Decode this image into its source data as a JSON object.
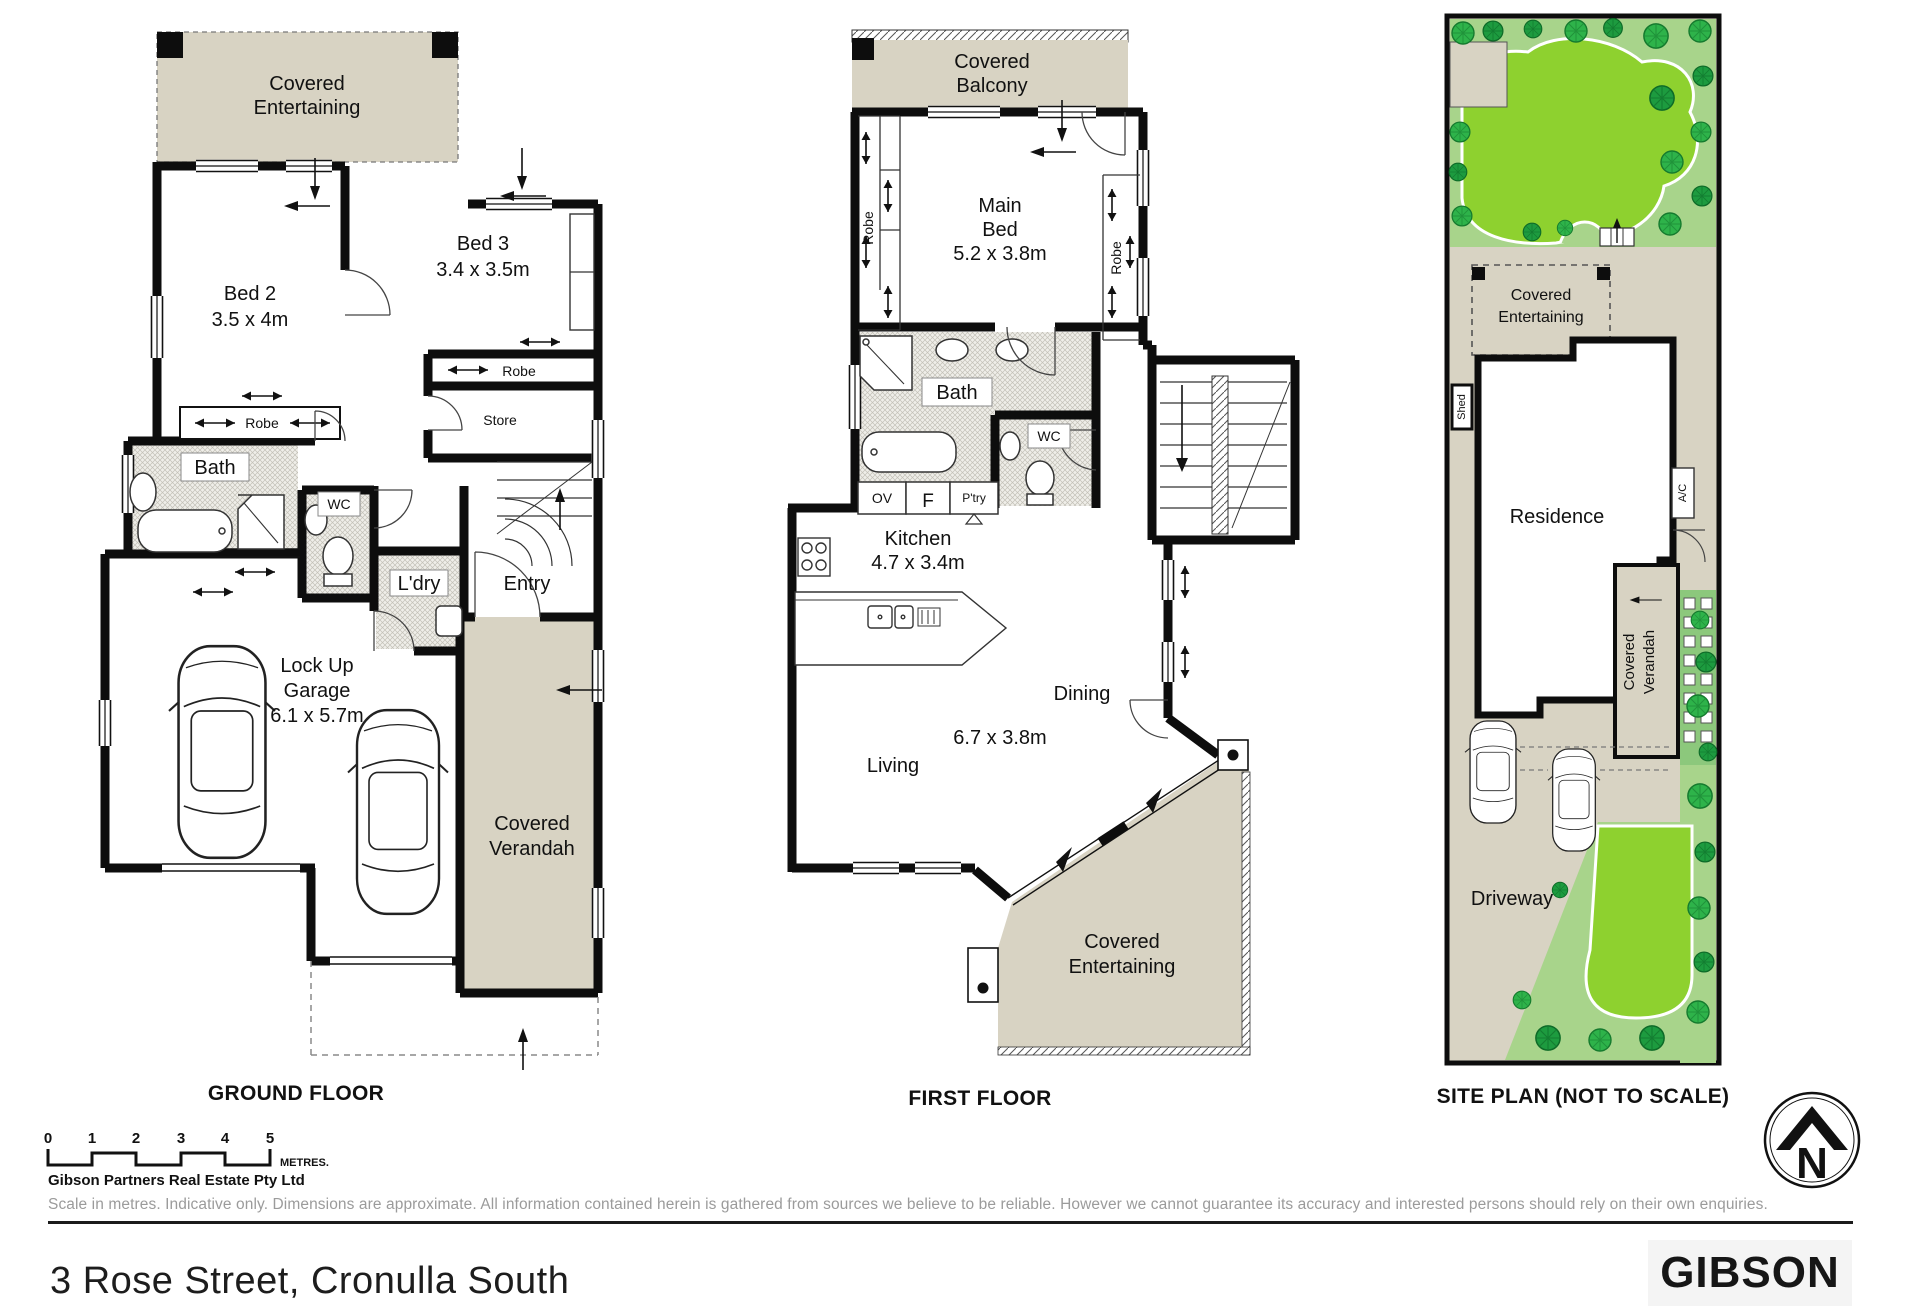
{
  "captions": {
    "ground": "GROUND FLOOR",
    "first": "FIRST FLOOR",
    "site": "SITE PLAN (NOT TO SCALE)"
  },
  "ground_floor": {
    "covered_entertaining": {
      "l1": "Covered",
      "l2": "Entertaining"
    },
    "bed2": {
      "name": "Bed 2",
      "dims": "3.5 x 4m"
    },
    "bed3": {
      "name": "Bed 3",
      "dims": "3.4 x 3.5m"
    },
    "robe_bed3": "Robe",
    "store": "Store",
    "robe_bed2": "Robe",
    "bath": "Bath",
    "wc": "WC",
    "ldry": "L'dry",
    "entry": "Entry",
    "garage": {
      "l1": "Lock Up",
      "l2": "Garage",
      "dims": "6.1 x 5.7m"
    },
    "verandah": {
      "l1": "Covered",
      "l2": "Verandah"
    }
  },
  "first_floor": {
    "balcony": {
      "l1": "Covered",
      "l2": "Balcony"
    },
    "main_bed": {
      "l1": "Main",
      "l2": "Bed",
      "dims": "5.2 x 3.8m"
    },
    "robe_left": "Robe",
    "robe_right": "Robe",
    "bath": "Bath",
    "wc": "WC",
    "ov": "OV",
    "f": "F",
    "ptry": "P'try",
    "kitchen": {
      "name": "Kitchen",
      "dims": "4.7 x 3.4m"
    },
    "living": "Living",
    "dining": "Dining",
    "living_dining_dims": "6.7 x 3.8m",
    "entertaining": {
      "l1": "Covered",
      "l2": "Entertaining"
    }
  },
  "site_plan": {
    "covered_entertaining": {
      "l1": "Covered",
      "l2": "Entertaining"
    },
    "residence": "Residence",
    "shed": "Shed",
    "ac": "A/C",
    "verandah": {
      "l1": "Covered",
      "l2": "Verandah"
    },
    "driveway": "Driveway"
  },
  "scale_bar": {
    "ticks": [
      "0",
      "1",
      "2",
      "3",
      "4",
      "5"
    ],
    "unit": "METRES."
  },
  "compass": {
    "north": "N"
  },
  "footer": {
    "company": "Gibson Partners Real Estate Pty Ltd",
    "disclaimer": "Scale in metres. Indicative only. Dimensions are approximate. All information contained herein is gathered from sources we believe to be reliable. However we cannot guarantee its accuracy and interested persons should rely on their own enquiries.",
    "address": "3 Rose Street, Cronulla South",
    "brand": "GIBSON"
  },
  "colors": {
    "covered_area": "#d8d3c3",
    "wall": "#0d0d0d",
    "garden_light": "#a8d48b",
    "lawn": "#8ed12f",
    "tree": "#2eb34a"
  }
}
